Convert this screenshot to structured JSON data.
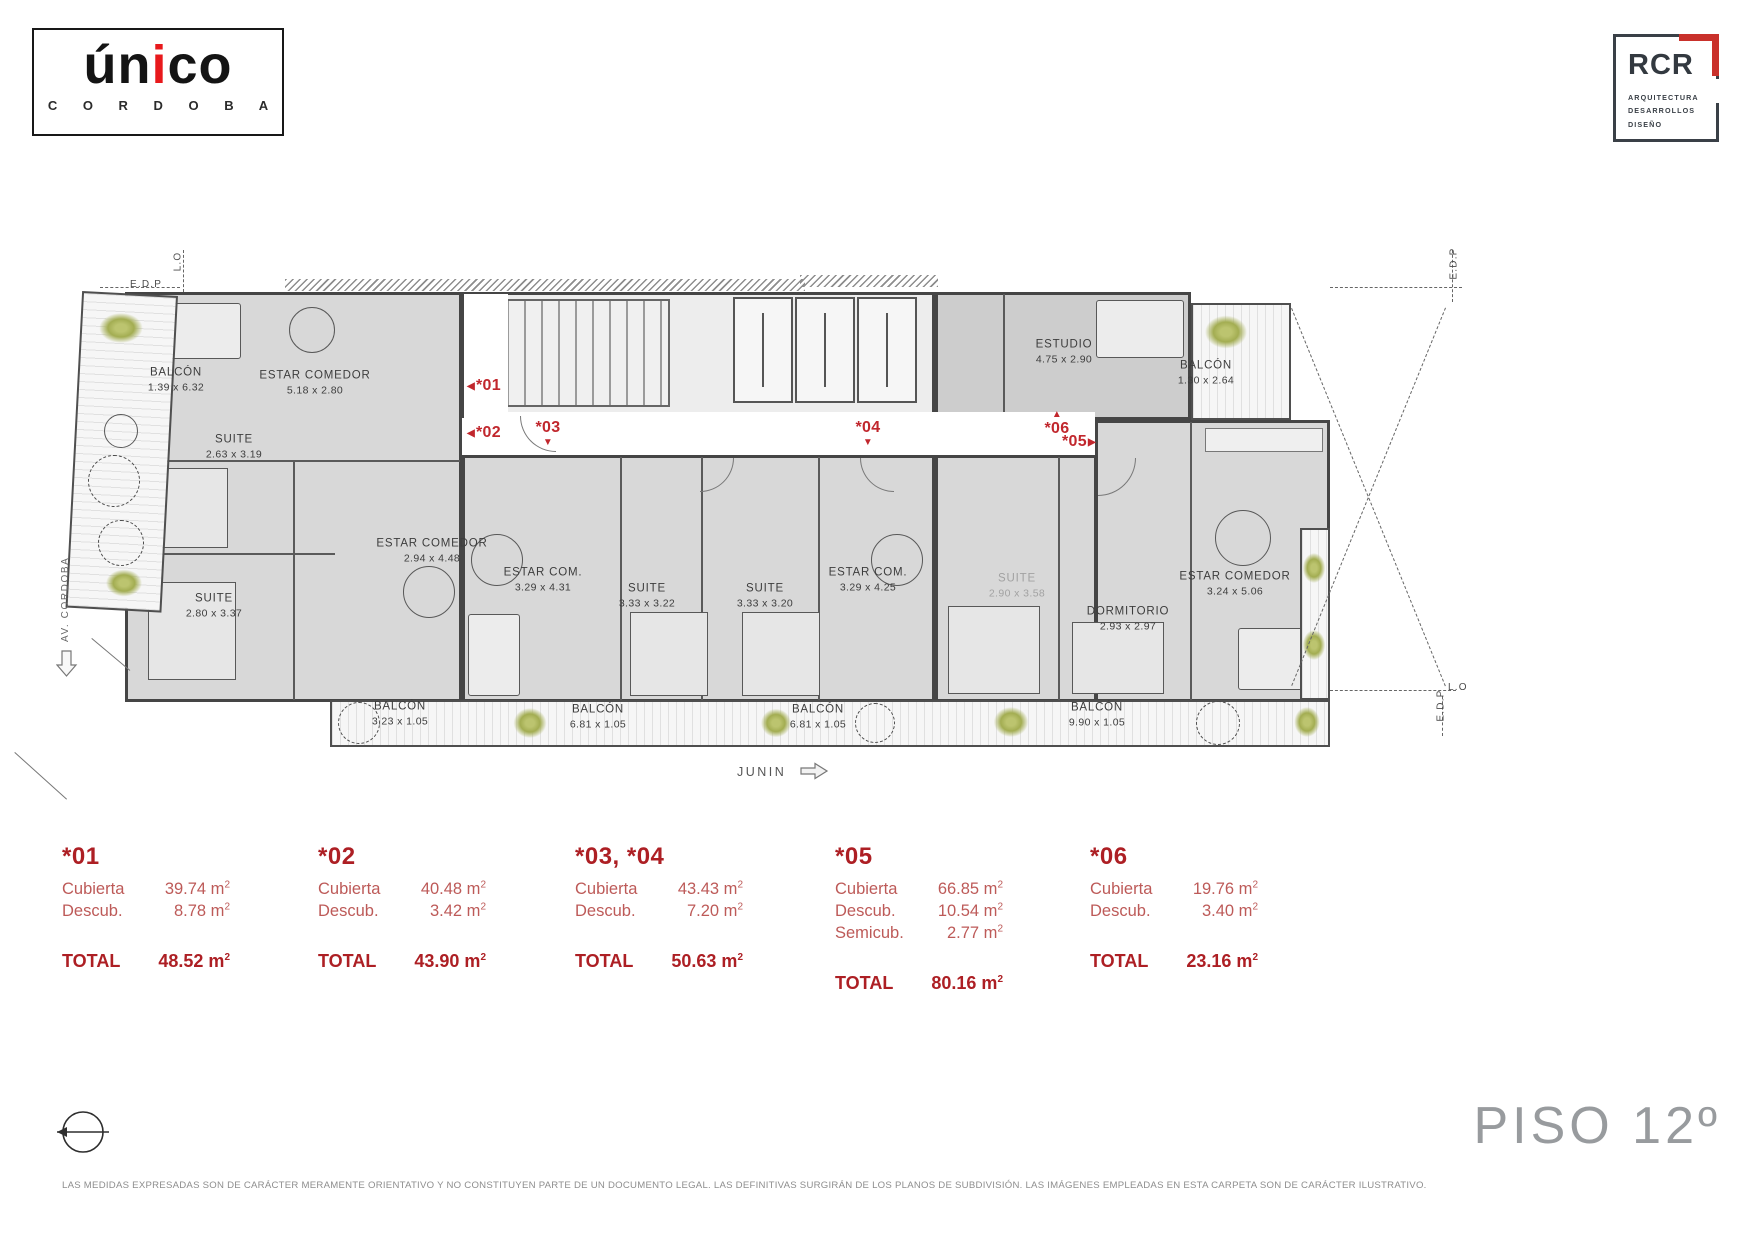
{
  "branding": {
    "unico_pre": "ún",
    "unico_i": "i",
    "unico_post": "co",
    "unico_city": "C O R D O B A",
    "rcr_name": "RCR",
    "rcr_sub1": "ARQUITECTURA",
    "rcr_sub2": "DESARROLLOS",
    "rcr_sub3": "DISEÑO"
  },
  "colors": {
    "accent_red": "#ad1f24",
    "marker_red": "#c1272d",
    "wall_gray": "#454545"
  },
  "plan": {
    "street_bottom": "JUNIN",
    "street_left": "AV. CORDOBA",
    "edge_labels": [
      {
        "text": "L.O",
        "x": 168,
        "y": 256,
        "rot": -90
      },
      {
        "text": "E.D.P",
        "x": 130,
        "y": 279,
        "rot": 0
      },
      {
        "text": "E.D.P",
        "x": 1438,
        "y": 258,
        "rot": -90
      },
      {
        "text": "L.O",
        "x": 1448,
        "y": 682,
        "rot": 0
      },
      {
        "text": "E.D.P",
        "x": 1425,
        "y": 700,
        "rot": -90
      }
    ],
    "rooms": [
      {
        "name": "BALCÓN",
        "dims": "1.39 x 6.32",
        "x": 176,
        "y": 380
      },
      {
        "name": "ESTAR COMEDOR",
        "dims": "5.18 x 2.80",
        "x": 315,
        "y": 383
      },
      {
        "name": "SUITE",
        "dims": "2.63 x 3.19",
        "x": 234,
        "y": 447
      },
      {
        "name": "SUITE",
        "dims": "2.80 x 3.37",
        "x": 214,
        "y": 606
      },
      {
        "name": "ESTAR COMEDOR",
        "dims": "2.94 x 4.48",
        "x": 432,
        "y": 551
      },
      {
        "name": "ESTAR COM.",
        "dims": "3.29 x 4.31",
        "x": 543,
        "y": 580
      },
      {
        "name": "SUITE",
        "dims": "3.33 x 3.22",
        "x": 647,
        "y": 596
      },
      {
        "name": "SUITE",
        "dims": "3.33 x 3.20",
        "x": 765,
        "y": 596
      },
      {
        "name": "ESTAR COM.",
        "dims": "3.29 x 4.25",
        "x": 868,
        "y": 580
      },
      {
        "name": "SUITE",
        "dims": "2.90 x 3.58",
        "x": 1017,
        "y": 586,
        "muted": true
      },
      {
        "name": "DORMITORIO",
        "dims": "2.93 x 2.97",
        "x": 1128,
        "y": 619
      },
      {
        "name": "ESTAR COMEDOR",
        "dims": "3.24 x 5.06",
        "x": 1235,
        "y": 584
      },
      {
        "name": "ESTUDIO",
        "dims": "4.75 x 2.90",
        "x": 1064,
        "y": 352
      },
      {
        "name": "BALCÓN",
        "dims": "1.30 x 2.64",
        "x": 1206,
        "y": 373
      },
      {
        "name": "BALCÓN",
        "dims": "3.23 x 1.05",
        "x": 400,
        "y": 714
      },
      {
        "name": "BALCÓN",
        "dims": "6.81 x 1.05",
        "x": 598,
        "y": 717
      },
      {
        "name": "BALCÓN",
        "dims": "6.81 x 1.05",
        "x": 818,
        "y": 717
      },
      {
        "name": "BALCÓN",
        "dims": "9.90 x 1.05",
        "x": 1097,
        "y": 715
      }
    ],
    "unit_markers": [
      {
        "id": "*01",
        "dir": "left",
        "x": 466,
        "y": 377
      },
      {
        "id": "*02",
        "dir": "left",
        "x": 466,
        "y": 424
      },
      {
        "id": "*03",
        "dir": "down",
        "x": 530,
        "y": 419
      },
      {
        "id": "*04",
        "dir": "down",
        "x": 850,
        "y": 419
      },
      {
        "id": "*06",
        "dir": "up",
        "x": 1039,
        "y": 409
      },
      {
        "id": "*05",
        "dir": "right",
        "x": 1062,
        "y": 433
      }
    ]
  },
  "area_tables": [
    {
      "unit": "*01",
      "x": 62,
      "rows": [
        {
          "label": "Cubierta",
          "value": "39.74 m²"
        },
        {
          "label": "Descub.",
          "value": "8.78 m²"
        }
      ],
      "total_label": "TOTAL",
      "total": "48.52 m²"
    },
    {
      "unit": "*02",
      "x": 318,
      "rows": [
        {
          "label": "Cubierta",
          "value": "40.48 m²"
        },
        {
          "label": "Descub.",
          "value": "3.42 m²"
        }
      ],
      "total_label": "TOTAL",
      "total": "43.90 m²"
    },
    {
      "unit": "*03, *04",
      "x": 575,
      "rows": [
        {
          "label": "Cubierta",
          "value": "43.43 m²"
        },
        {
          "label": "Descub.",
          "value": "7.20 m²"
        }
      ],
      "total_label": "TOTAL",
      "total": "50.63 m²"
    },
    {
      "unit": "*05",
      "x": 835,
      "rows": [
        {
          "label": "Cubierta",
          "value": "66.85 m²"
        },
        {
          "label": "Descub.",
          "value": "10.54 m²"
        },
        {
          "label": "Semicub.",
          "value": "2.77 m²"
        }
      ],
      "total_label": "TOTAL",
      "total": "80.16 m²"
    },
    {
      "unit": "*06",
      "x": 1090,
      "rows": [
        {
          "label": "Cubierta",
          "value": "19.76 m²"
        },
        {
          "label": "Descub.",
          "value": "3.40 m²"
        }
      ],
      "total_label": "TOTAL",
      "total": "23.16 m²"
    }
  ],
  "floor_title": "PISO 12º",
  "disclaimer": "LAS MEDIDAS EXPRESADAS SON DE CARÁCTER MERAMENTE ORIENTATIVO Y NO CONSTITUYEN PARTE DE UN DOCUMENTO LEGAL. LAS DEFINITIVAS SURGIRÁN DE LOS PLANOS DE SUBDIVISIÓN. LAS IMÁGENES EMPLEADAS EN ESTA CARPETA SON DE CARÁCTER ILUSTRATIVO."
}
